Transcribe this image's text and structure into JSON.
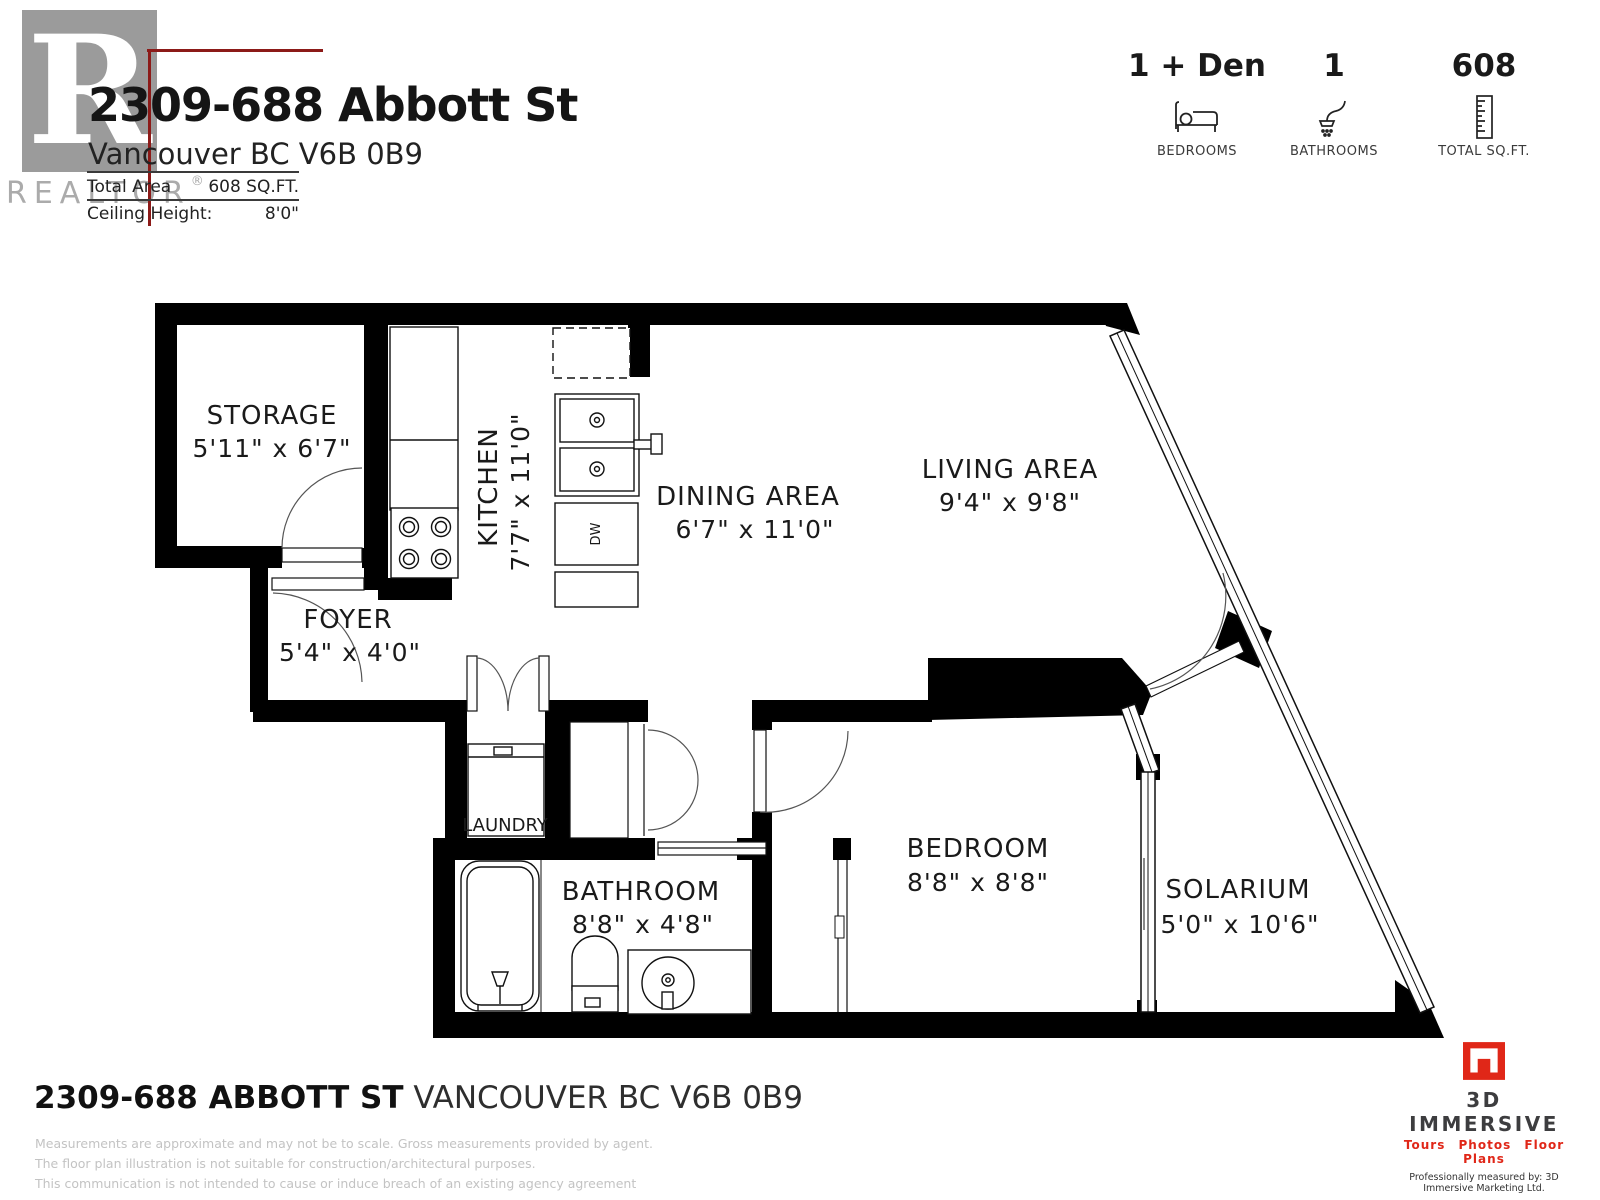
{
  "header": {
    "watermark_name": "REALTOR",
    "watermark_reg": "®",
    "title": "2309-688 Abbott St",
    "subtitle": "Vancouver BC V6B 0B9",
    "total_area_label": "Total Area",
    "total_area_value": "608 SQ.FT.",
    "ceiling_height_label": "Ceiling Height:",
    "ceiling_height_value": "8'0\"",
    "stats": [
      {
        "value": "1 + Den",
        "label": "BEDROOMS"
      },
      {
        "value": "1",
        "label": "BATHROOMS"
      },
      {
        "value": "608",
        "label": "TOTAL SQ.FT."
      }
    ]
  },
  "floorplan": {
    "rooms": [
      {
        "name": "STORAGE",
        "dims": "5'11\" x 6'7\""
      },
      {
        "name": "FOYER",
        "dims": "5'4\" x 4'0\""
      },
      {
        "name": "KITCHEN",
        "dims": "7'7\" x 11'0\""
      },
      {
        "name": "DINING AREA",
        "dims": "6'7\" x 11'0\""
      },
      {
        "name": "LIVING AREA",
        "dims": "9'4\" x 9'8\""
      },
      {
        "name": "LAUNDRY",
        "dims": ""
      },
      {
        "name": "BATHROOM",
        "dims": "8'8\" x 4'8\""
      },
      {
        "name": "BEDROOM",
        "dims": "8'8\" x 8'8\""
      },
      {
        "name": "SOLARIUM",
        "dims": "5'0\" x 10'6\""
      }
    ],
    "dishwasher_label": "DW"
  },
  "footer": {
    "address_bold": "2309-688 ABBOTT ST",
    "address_rest": "VANCOUVER BC V6B 0B9",
    "disclaimers": [
      "Measurements are approximate and may not be to scale. Gross measurements provided by agent.",
      "The floor plan illustration is not suitable for construction/architectural purposes.",
      "This communication is not intended to cause or induce breach of an existing agency agreement"
    ]
  },
  "branding": {
    "name": "3D IMMERSIVE",
    "tagline": "Tours  Photos  Floor Plans",
    "measured_by": "Professionally measured by: 3D Immersive Marketing Ltd.",
    "lead_label": "Lead Floor Planner:",
    "lead_name": "Siva Alexander",
    "qa_label": "Quality Assurance:",
    "qa_name": "Jannie Graham"
  },
  "colors": {
    "wall": "#000000",
    "line": "#111111",
    "accent_red": "#8c1a18",
    "logo_red": "#e02718",
    "watermark_gray": "#ababab",
    "fineprint_gray": "#c3c3c3",
    "brand_dark": "#3d3d3f"
  }
}
